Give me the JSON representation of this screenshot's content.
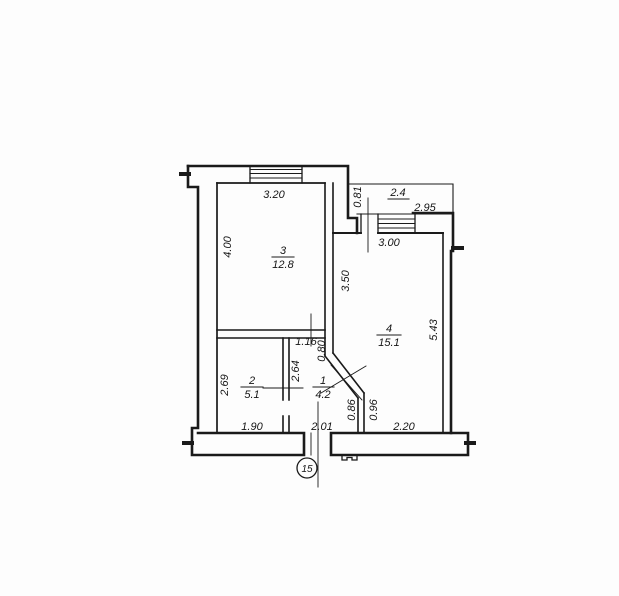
{
  "drawing": {
    "rooms": [
      {
        "id": "room-3",
        "number": "3",
        "area": "12.8"
      },
      {
        "id": "room-4",
        "number": "4",
        "area": "15.1"
      },
      {
        "id": "room-2",
        "number": "2",
        "area": "5.1"
      },
      {
        "id": "room-1",
        "number": "1",
        "area": "4.2"
      }
    ],
    "balcony_area": "2.4",
    "section_mark": "15",
    "dimensions": {
      "room3_width": "3.20",
      "room3_depth": "4.00",
      "balcony_recess": "0.81",
      "balcony_width": "2.95",
      "room4_window_width": "3.00",
      "room4_upper_depth": "3.50",
      "room4_depth": "5.43",
      "hall_top_width": "1.16",
      "hall_door_width": "0.80",
      "hall_depth": "2.64",
      "room2_depth": "2.69",
      "room2_width": "1.90",
      "hall_width": "2.01",
      "wall_segment_left": "0.86",
      "wall_segment_right": "0.96",
      "room4_bottom_width": "2.20"
    }
  }
}
